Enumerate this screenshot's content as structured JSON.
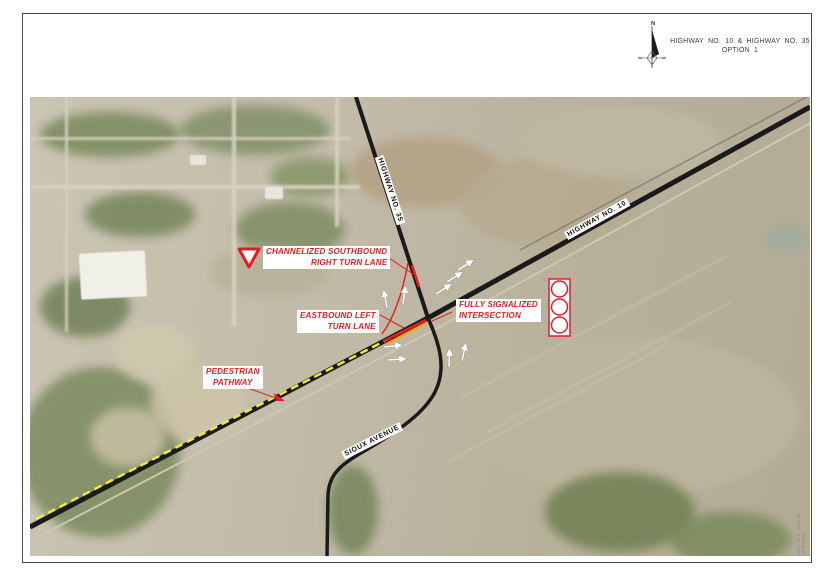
{
  "page": {
    "title_line1": "HIGHWAY  NO.  10  &  HIGHWAY  NO.  35",
    "title_line2": "OPTION  1"
  },
  "north": {
    "label": "N"
  },
  "roads": {
    "highway35": "HIGHWAY NO. 35",
    "highway10": "HIGHWAY NO. 10",
    "sioux_avenue": "SIOUX AVENUE"
  },
  "callouts": {
    "channelized": {
      "line1": "CHANNELIZED SOUTHBOUND",
      "line2": "RIGHT TURN LANE"
    },
    "eastbound": {
      "line1": "EASTBOUND LEFT",
      "line2": "TURN LANE"
    },
    "signalized": {
      "line1": "FULLY SIGNALIZED",
      "line2": "INTERSECTION"
    },
    "pedestrian": {
      "line1": "PEDESTRIAN",
      "line2": "PATHWAY"
    }
  },
  "symbols": {
    "yield_sign": "channelized right-turn yield symbol",
    "traffic_signal": "three-lens signal head symbol",
    "lane_arrows": "white pavement lane-use arrows at intersection"
  },
  "colors": {
    "annotation_red": "#e31c23",
    "pathway_yellow": "#efe93d",
    "channelization_orange": "#ff9d00",
    "road_black": "#1a1a1a"
  },
  "stamp": {
    "text": "HWY 10 & HWY 35 - OPTION 1"
  }
}
